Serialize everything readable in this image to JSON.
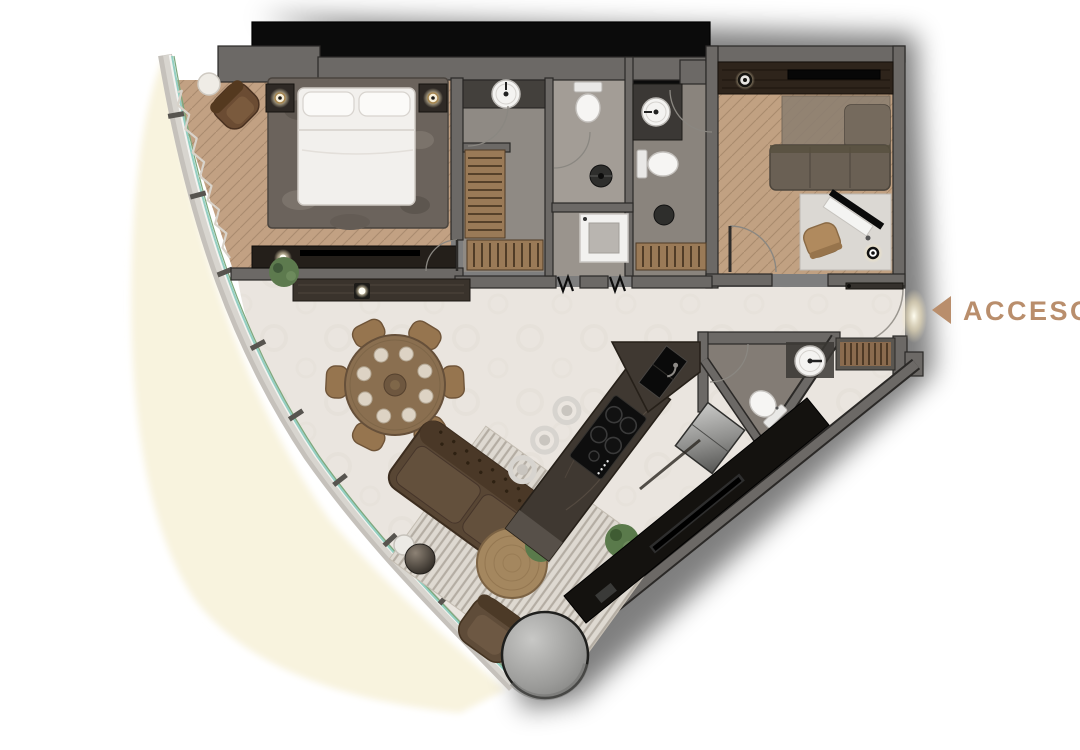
{
  "access": {
    "label": "ACCESO",
    "color": "#b98e6c",
    "icon": "arrow-left-icon"
  },
  "palette": {
    "background": "#ffffff",
    "balcony_cream": "#f8f3de",
    "wall_grey": "#6c6966",
    "wall_outline": "#2b2927",
    "shaft_black": "#0b0b0b",
    "wood_floor": "#c2a183",
    "stone_floor": "#eae5df",
    "bath_floor": "#938d86",
    "glass_teal": "#93cfc2",
    "accent_tan": "#b98e6c"
  },
  "inventory": {
    "beds": 1,
    "dining_seats": 6,
    "dining_place_settings": 8,
    "bar_stools": 3,
    "toilets": 4,
    "round_sinks": 3,
    "shower_drains": 2,
    "sofas": 2,
    "armchairs": 2,
    "desks": 1,
    "refrigerators": 1,
    "cooktop_burners": 5,
    "wardrobe_units": 4,
    "structural_columns": 1,
    "entry_doors": 1
  }
}
